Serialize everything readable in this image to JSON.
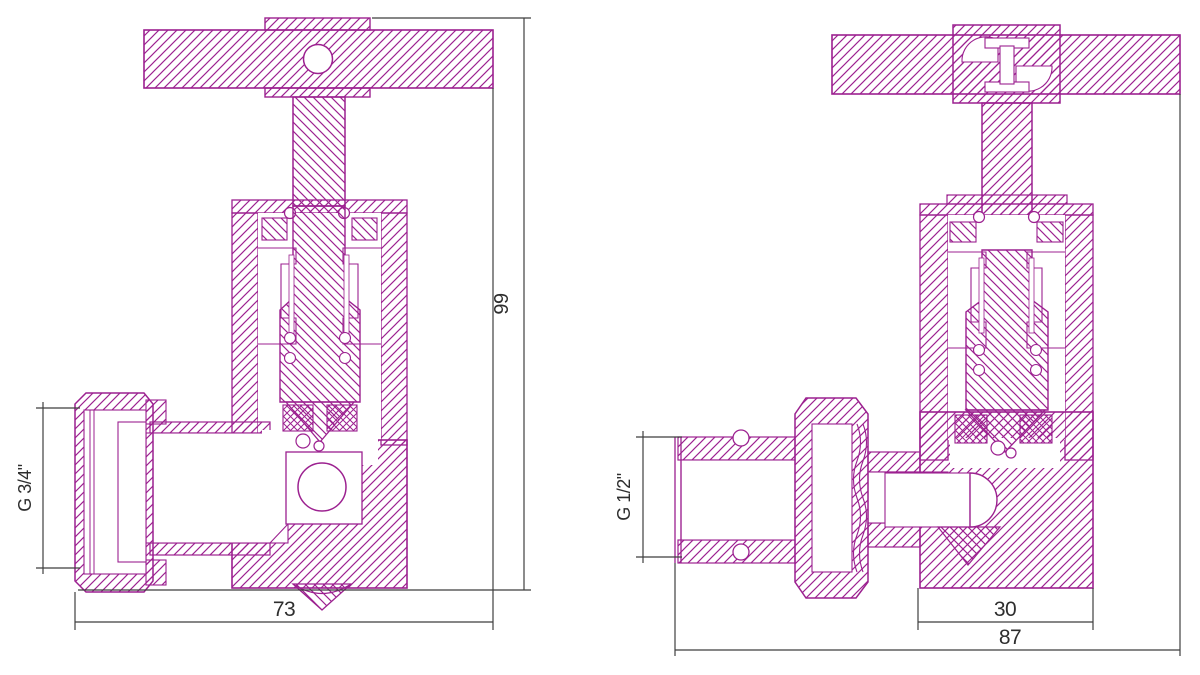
{
  "palette": {
    "drawing_line": "#9c2190",
    "dimension_line": "#3f3f3f",
    "text": "#2e2e2e",
    "background": "#ffffff"
  },
  "views": {
    "left": {
      "name": "angle-valve-cross-section-left",
      "thread_label": "G 3/4\"",
      "height_label": "99",
      "width_label": "73"
    },
    "right": {
      "name": "angle-valve-cross-section-right",
      "thread_label": "G 1/2\"",
      "body_width_label": "30",
      "width_label": "87"
    }
  }
}
